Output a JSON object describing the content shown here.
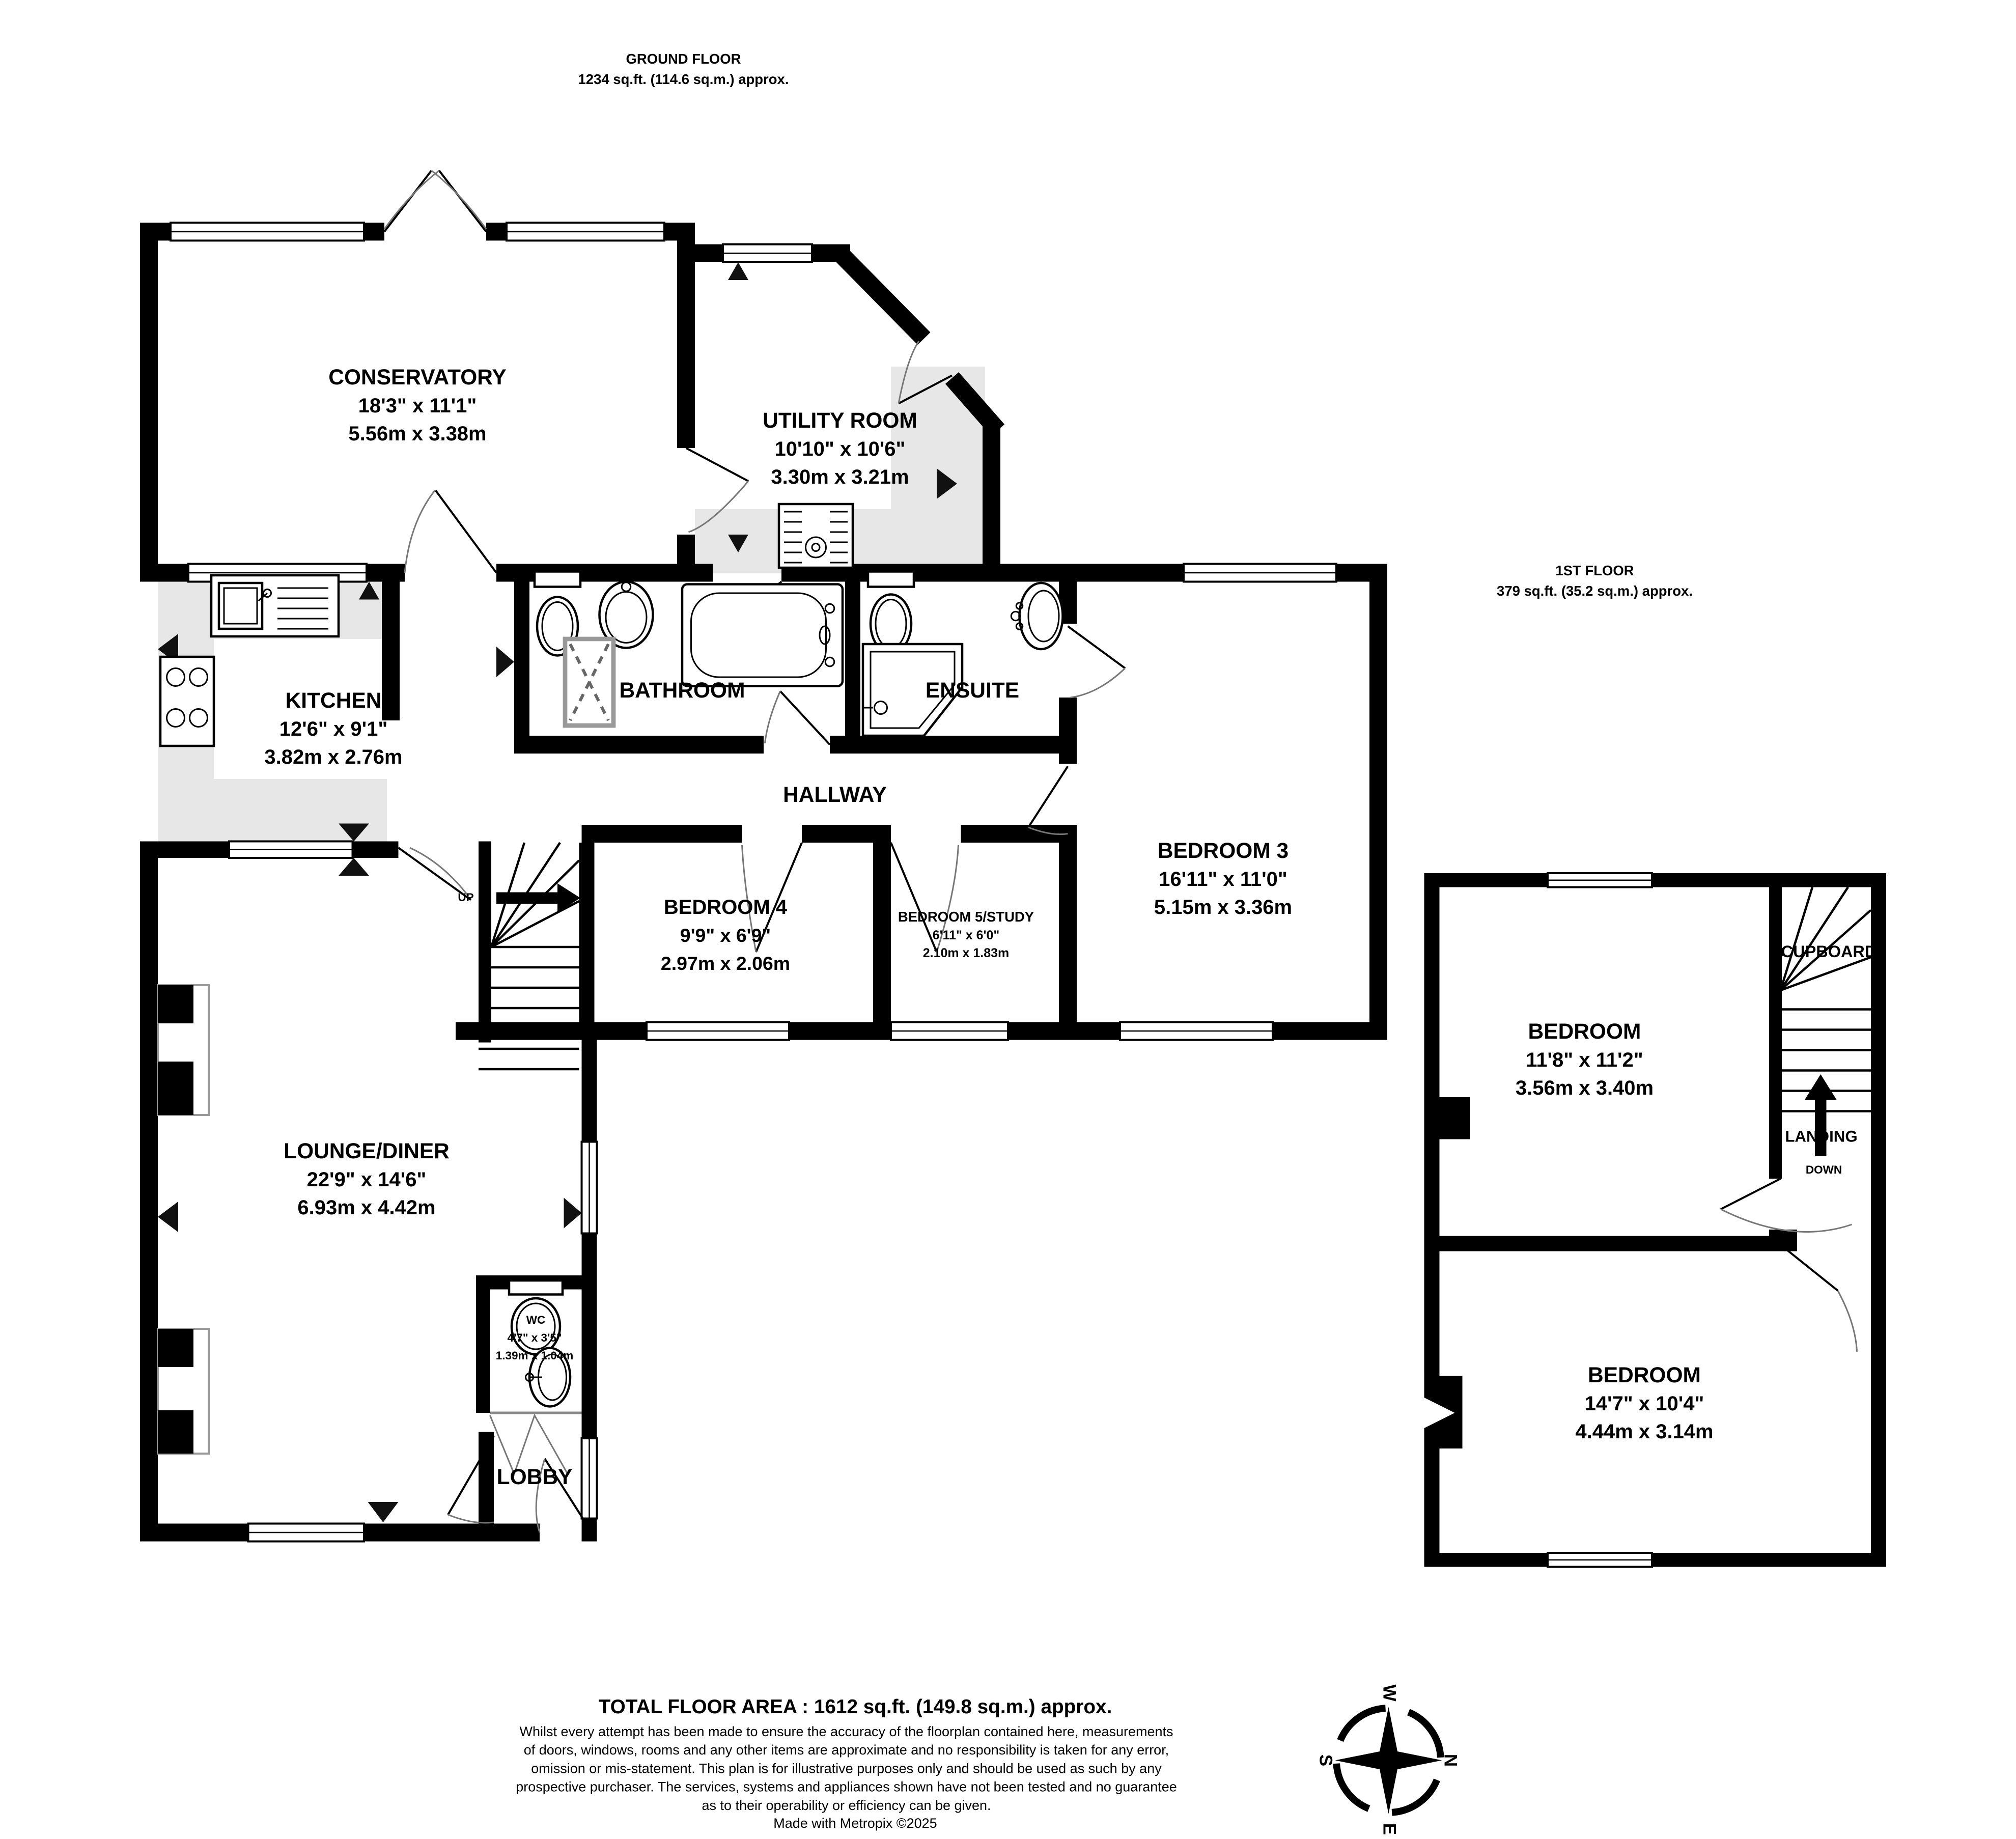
{
  "ground_floor_header": {
    "title": "GROUND FLOOR",
    "area": "1234 sq.ft. (114.6 sq.m.) approx."
  },
  "first_floor_header": {
    "title": "1ST FLOOR",
    "area": "379 sq.ft. (35.2 sq.m.) approx."
  },
  "rooms": {
    "conservatory": {
      "name": "CONSERVATORY",
      "imperial": "18'3\" x 11'1\"",
      "metric": "5.56m x 3.38m"
    },
    "utility": {
      "name": "UTILITY ROOM",
      "imperial": "10'10\" x 10'6\"",
      "metric": "3.30m x 3.21m"
    },
    "kitchen": {
      "name": "KITCHEN",
      "imperial": "12'6\" x 9'1\"",
      "metric": "3.82m x 2.76m"
    },
    "bathroom": {
      "name": "BATHROOM"
    },
    "ensuite": {
      "name": "ENSUITE"
    },
    "hallway": {
      "name": "HALLWAY"
    },
    "bedroom3": {
      "name": "BEDROOM 3",
      "imperial": "16'11\" x 11'0\"",
      "metric": "5.15m x 3.36m"
    },
    "bedroom4": {
      "name": "BEDROOM 4",
      "imperial": "9'9\" x 6'9\"",
      "metric": "2.97m x 2.06m"
    },
    "bedroom5": {
      "name": "BEDROOM 5/STUDY",
      "imperial": "6'11\" x 6'0\"",
      "metric": "2.10m x 1.83m"
    },
    "lounge": {
      "name": "LOUNGE/DINER",
      "imperial": "22'9\" x 14'6\"",
      "metric": "6.93m x 4.42m"
    },
    "wc": {
      "name": "WC",
      "imperial": "4'7\" x 3'5\"",
      "metric": "1.39m x 1.04m"
    },
    "lobby": {
      "name": "LOBBY"
    },
    "bedroom_ff_top": {
      "name": "BEDROOM",
      "imperial": "11'8\" x 11'2\"",
      "metric": "3.56m x 3.40m"
    },
    "bedroom_ff_bottom": {
      "name": "BEDROOM",
      "imperial": "14'7\" x 10'4\"",
      "metric": "4.44m x 3.14m"
    },
    "landing": {
      "name": "LANDING"
    },
    "cupboard": {
      "name": "CUPBOARD"
    }
  },
  "stairs": {
    "up": "UP",
    "down": "DOWN"
  },
  "compass": {
    "north": "N",
    "south": "S",
    "east": "E",
    "west": "W"
  },
  "footer": {
    "total": "TOTAL FLOOR AREA : 1612 sq.ft. (149.8 sq.m.) approx.",
    "disclaimer_lines": [
      "Whilst every attempt has been made to ensure the accuracy of the floorplan contained here, measurements",
      "of doors, windows, rooms and any other items are approximate and no responsibility is taken for any error,",
      "omission or mis-statement. This plan is for illustrative purposes only and should be used as such by any",
      "prospective purchaser. The services, systems and appliances shown have not been tested and no guarantee",
      "as to their operability or efficiency can be given."
    ],
    "credit": "Made with Metropix ©2025"
  }
}
